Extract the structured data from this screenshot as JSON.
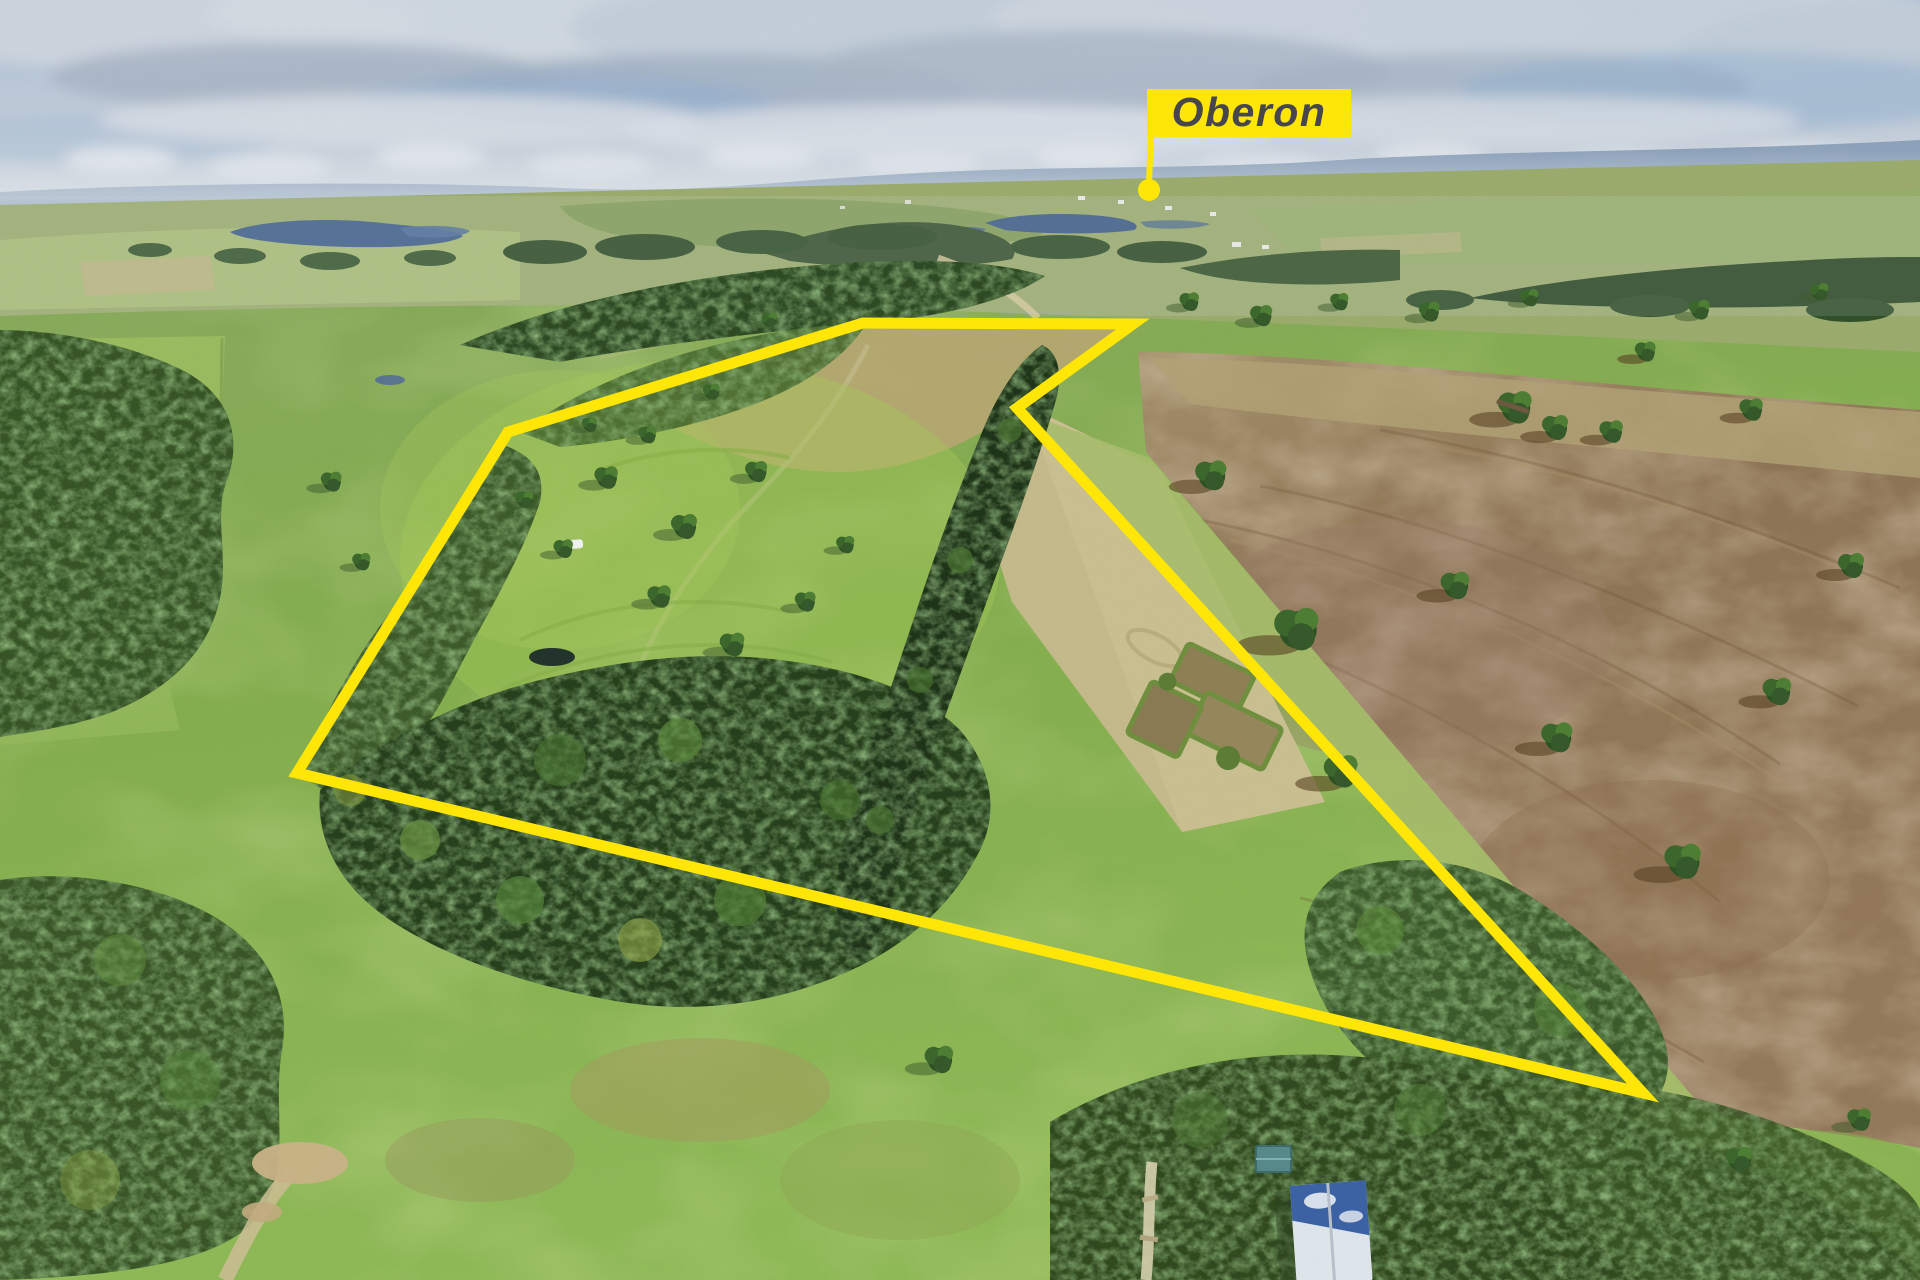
{
  "image": {
    "kind": "aerial-property-photograph",
    "width_px": 1920,
    "height_px": 1280,
    "scene": "rural acreage with pine windbreaks, pastures, ploughed paddock, distant lake and town"
  },
  "overlay": {
    "location_label": {
      "text": "Oberon",
      "text_color": "#46464b",
      "background_color": "#ffe606",
      "marker": "leader-line-with-dot",
      "dot_cx": "1149",
      "dot_cy": "190",
      "dot_r": "11"
    },
    "property_boundary": {
      "color": "#ffe606",
      "stroke_width_px": "11",
      "points": "508,432 863,323 1133,324 1017,408 1643,1093 297,773"
    }
  },
  "palette": {
    "sky": "#b7c6d6",
    "mountains": "#7e94b0",
    "lake": "#42608a",
    "pasture_green": "#8fb751",
    "dry_grass": "#c3b98a",
    "ploughed_field": "#8c7354",
    "pine_forest": "#243c1b",
    "eucalypt_forest": "#3a5628"
  }
}
